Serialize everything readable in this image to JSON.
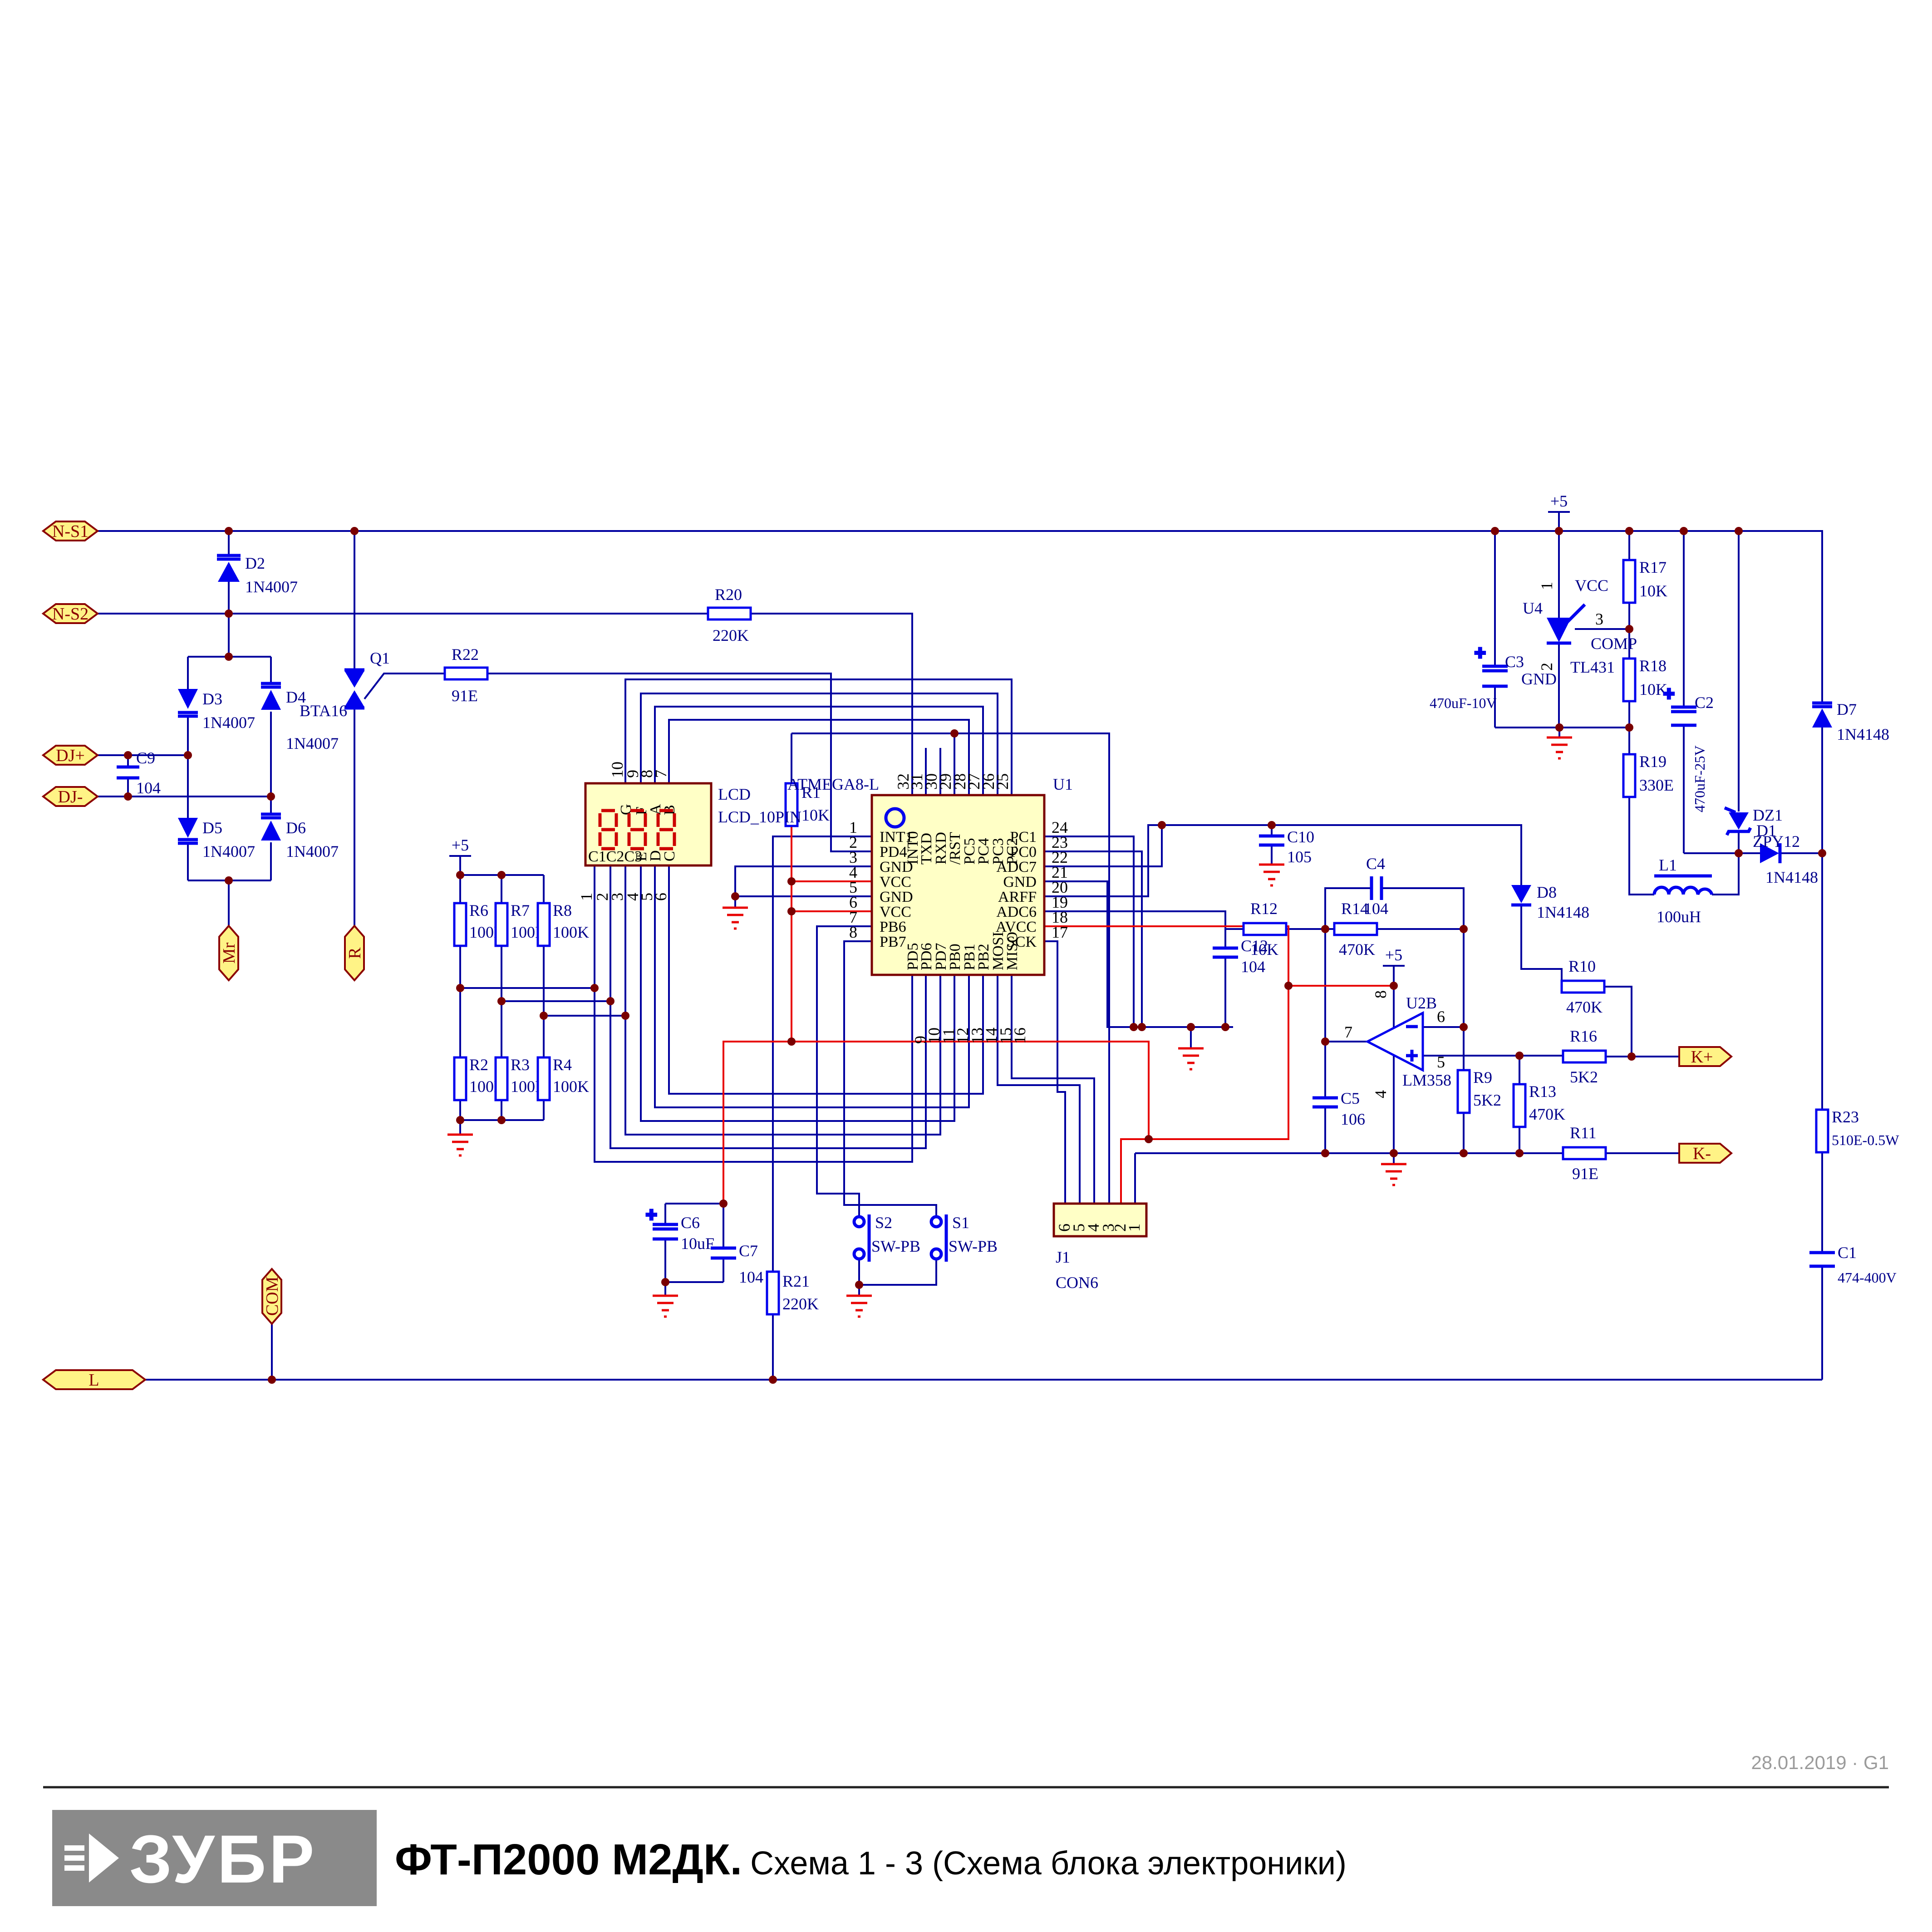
{
  "footer": {
    "brand": "ЗУБР",
    "title_bold": "ФТ-П2000 М2ДК.",
    "title_rest": "Схема 1 - 3 (Схема блока электроники)",
    "date": "28.01.2019 · G1"
  },
  "flags": {
    "ns1": "N-S1",
    "ns2": "N-S2",
    "djp": "DJ+",
    "djm": "DJ-",
    "mr": "Mr",
    "r": "R",
    "com": "COM",
    "l": "L",
    "kp": "K+",
    "km": "K-"
  },
  "power": {
    "p5": "+5"
  },
  "components": {
    "D1": {
      "ref": "D1",
      "value": "1N4148"
    },
    "D2": {
      "ref": "D2",
      "value": "1N4007"
    },
    "D3": {
      "ref": "D3",
      "value": "1N4007"
    },
    "D4": {
      "ref": "D4",
      "value": "1N4007"
    },
    "D5": {
      "ref": "D5",
      "value": "1N4007"
    },
    "D6": {
      "ref": "D6",
      "value": "1N4007"
    },
    "D7": {
      "ref": "D7",
      "value": "1N4148"
    },
    "D8": {
      "ref": "D8",
      "value": "1N4148"
    },
    "DZ1": {
      "ref": "DZ1",
      "value": "ZPY12"
    },
    "Q1": {
      "ref": "Q1",
      "value": "BTA16"
    },
    "L1": {
      "ref": "L1",
      "value": "100uH"
    },
    "R1": {
      "ref": "R1",
      "value": "10K"
    },
    "R2": {
      "ref": "R2",
      "value": "100K"
    },
    "R3": {
      "ref": "R3",
      "value": "100K"
    },
    "R4": {
      "ref": "R4",
      "value": "100K"
    },
    "R6": {
      "ref": "R6",
      "value": "100K"
    },
    "R7": {
      "ref": "R7",
      "value": "100K"
    },
    "R8": {
      "ref": "R8",
      "value": "100K"
    },
    "R9": {
      "ref": "R9",
      "value": "5K2"
    },
    "R10": {
      "ref": "R10",
      "value": "470K"
    },
    "R11": {
      "ref": "R11",
      "value": "91E"
    },
    "R12": {
      "ref": "R12",
      "value": "10K"
    },
    "R13": {
      "ref": "R13",
      "value": "470K"
    },
    "R14": {
      "ref": "R14",
      "value": "470K"
    },
    "R16": {
      "ref": "R16",
      "value": "5K2"
    },
    "R17": {
      "ref": "R17",
      "value": "10K"
    },
    "R18": {
      "ref": "R18",
      "value": "10K"
    },
    "R19": {
      "ref": "R19",
      "value": "330E"
    },
    "R20": {
      "ref": "R20",
      "value": "220K"
    },
    "R21": {
      "ref": "R21",
      "value": "220K"
    },
    "R22": {
      "ref": "R22",
      "value": "91E"
    },
    "R23": {
      "ref": "R23",
      "value": "510E-0.5W"
    },
    "C1": {
      "ref": "C1",
      "value": "474-400V"
    },
    "C2": {
      "ref": "C2",
      "value": "470uF-25V"
    },
    "C3": {
      "ref": "C3",
      "value": "470uF-10V"
    },
    "C4": {
      "ref": "C4",
      "value": "104"
    },
    "C5": {
      "ref": "C5",
      "value": "106"
    },
    "C6": {
      "ref": "C6",
      "value": "10uF"
    },
    "C7": {
      "ref": "C7",
      "value": "104"
    },
    "C9": {
      "ref": "C9",
      "value": "104"
    },
    "C10": {
      "ref": "C10",
      "value": "105"
    },
    "C12": {
      "ref": "C12",
      "value": "104"
    },
    "S1": {
      "ref": "S1",
      "value": "SW-PB"
    },
    "S2": {
      "ref": "S2",
      "value": "SW-PB"
    }
  },
  "u1": {
    "ref": "U1",
    "part": "ATMEGA8-L",
    "top": [
      {
        "n": "32",
        "name": "INT0"
      },
      {
        "n": "31",
        "name": "TXD"
      },
      {
        "n": "30",
        "name": "RXD"
      },
      {
        "n": "29",
        "name": "/RST"
      },
      {
        "n": "28",
        "name": "PC5"
      },
      {
        "n": "27",
        "name": "PC4"
      },
      {
        "n": "26",
        "name": "PC3"
      },
      {
        "n": "25",
        "name": "PC2"
      }
    ],
    "left": [
      {
        "n": "1",
        "name": "INT1"
      },
      {
        "n": "2",
        "name": "PD4"
      },
      {
        "n": "3",
        "name": "GND"
      },
      {
        "n": "4",
        "name": "VCC"
      },
      {
        "n": "5",
        "name": "GND"
      },
      {
        "n": "6",
        "name": "VCC"
      },
      {
        "n": "7",
        "name": "PB6"
      },
      {
        "n": "8",
        "name": "PB7"
      }
    ],
    "right": [
      {
        "n": "24",
        "name": "PC1"
      },
      {
        "n": "23",
        "name": "PC0"
      },
      {
        "n": "22",
        "name": "ADC7"
      },
      {
        "n": "21",
        "name": "GND"
      },
      {
        "n": "20",
        "name": "ARFF"
      },
      {
        "n": "19",
        "name": "ADC6"
      },
      {
        "n": "18",
        "name": "AVCC"
      },
      {
        "n": "17",
        "name": "SCK"
      }
    ],
    "bottom": [
      {
        "n": "9",
        "name": "PD5"
      },
      {
        "n": "10",
        "name": "PD6"
      },
      {
        "n": "11",
        "name": "PD7"
      },
      {
        "n": "12",
        "name": "PB0"
      },
      {
        "n": "13",
        "name": "PB1"
      },
      {
        "n": "14",
        "name": "PB2"
      },
      {
        "n": "15",
        "name": "MOSI"
      },
      {
        "n": "16",
        "name": "MISO"
      }
    ]
  },
  "u4": {
    "ref": "U4",
    "part": "TL431",
    "pin1": "1",
    "pin1_name": "VCC",
    "pin2": "2",
    "pin2_name": "GND",
    "pin3": "3",
    "pin3_name": "COMP"
  },
  "u2b": {
    "ref": "U2B",
    "part": "LM358",
    "pin_out": "7",
    "pin_minus": "6",
    "pin_plus": "5",
    "pin_vcc": "8",
    "pin_gnd": "4"
  },
  "lcd": {
    "ref": "LCD",
    "part": "LCD_10PIN",
    "top_pins": [
      "10",
      "9",
      "8",
      "7"
    ],
    "top_segs": [
      "G",
      "F",
      "A",
      "B"
    ],
    "bottom_pins": [
      "1",
      "2",
      "3",
      "4",
      "5",
      "6"
    ],
    "bottom_group": "C1C2C3",
    "bottom_rot": [
      "E",
      "D",
      "C"
    ]
  },
  "j1": {
    "ref": "J1",
    "part": "CON6",
    "pins": [
      "6",
      "5",
      "4",
      "3",
      "2",
      "1"
    ]
  }
}
